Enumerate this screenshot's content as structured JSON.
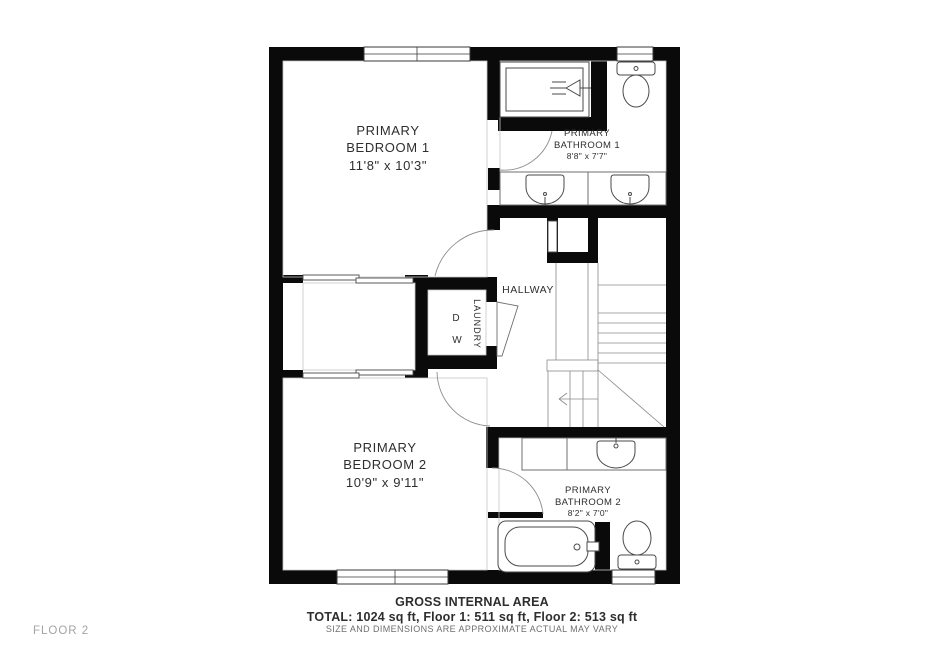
{
  "floor_label": "FLOOR 2",
  "rooms": {
    "bedroom1": {
      "line1": "PRIMARY",
      "line2": "BEDROOM 1",
      "dims": "11'8\" x 10'3\""
    },
    "bathroom1": {
      "line1": "PRIMARY",
      "line2": "BATHROOM 1",
      "dims": "8'8\" x 7'7\""
    },
    "bedroom2": {
      "line1": "PRIMARY",
      "line2": "BEDROOM 2",
      "dims": "10'9\" x 9'11\""
    },
    "bathroom2": {
      "line1": "PRIMARY",
      "line2": "BATHROOM 2",
      "dims": "8'2\" x 7'0\""
    },
    "hallway": {
      "label": "HALLWAY"
    },
    "laundry": {
      "label": "LAUNDRY",
      "appliance_d": "D",
      "appliance_w": "W"
    }
  },
  "fixtures": {
    "bathroom1": [
      "shower",
      "toilet",
      "double-vanity-sinks"
    ],
    "bathroom2": [
      "vanity-sink",
      "bathtub",
      "toilet"
    ],
    "circulation": [
      "stairs-with-down-arrow",
      "linen-closet",
      "bypass-closet-doors"
    ]
  },
  "footer": {
    "title": "GROSS INTERNAL AREA",
    "totals": "TOTAL: 1024 sq ft, Floor 1: 511 sq ft, Floor 2: 513 sq ft",
    "disclaimer": "SIZE AND DIMENSIONS ARE APPROXIMATE ACTUAL MAY VARY"
  },
  "colors": {
    "wall": "#0a0a0a",
    "fixture_stroke": "#4a4a4a",
    "text": "#2e2e2e",
    "muted": "#a3a3a3"
  }
}
